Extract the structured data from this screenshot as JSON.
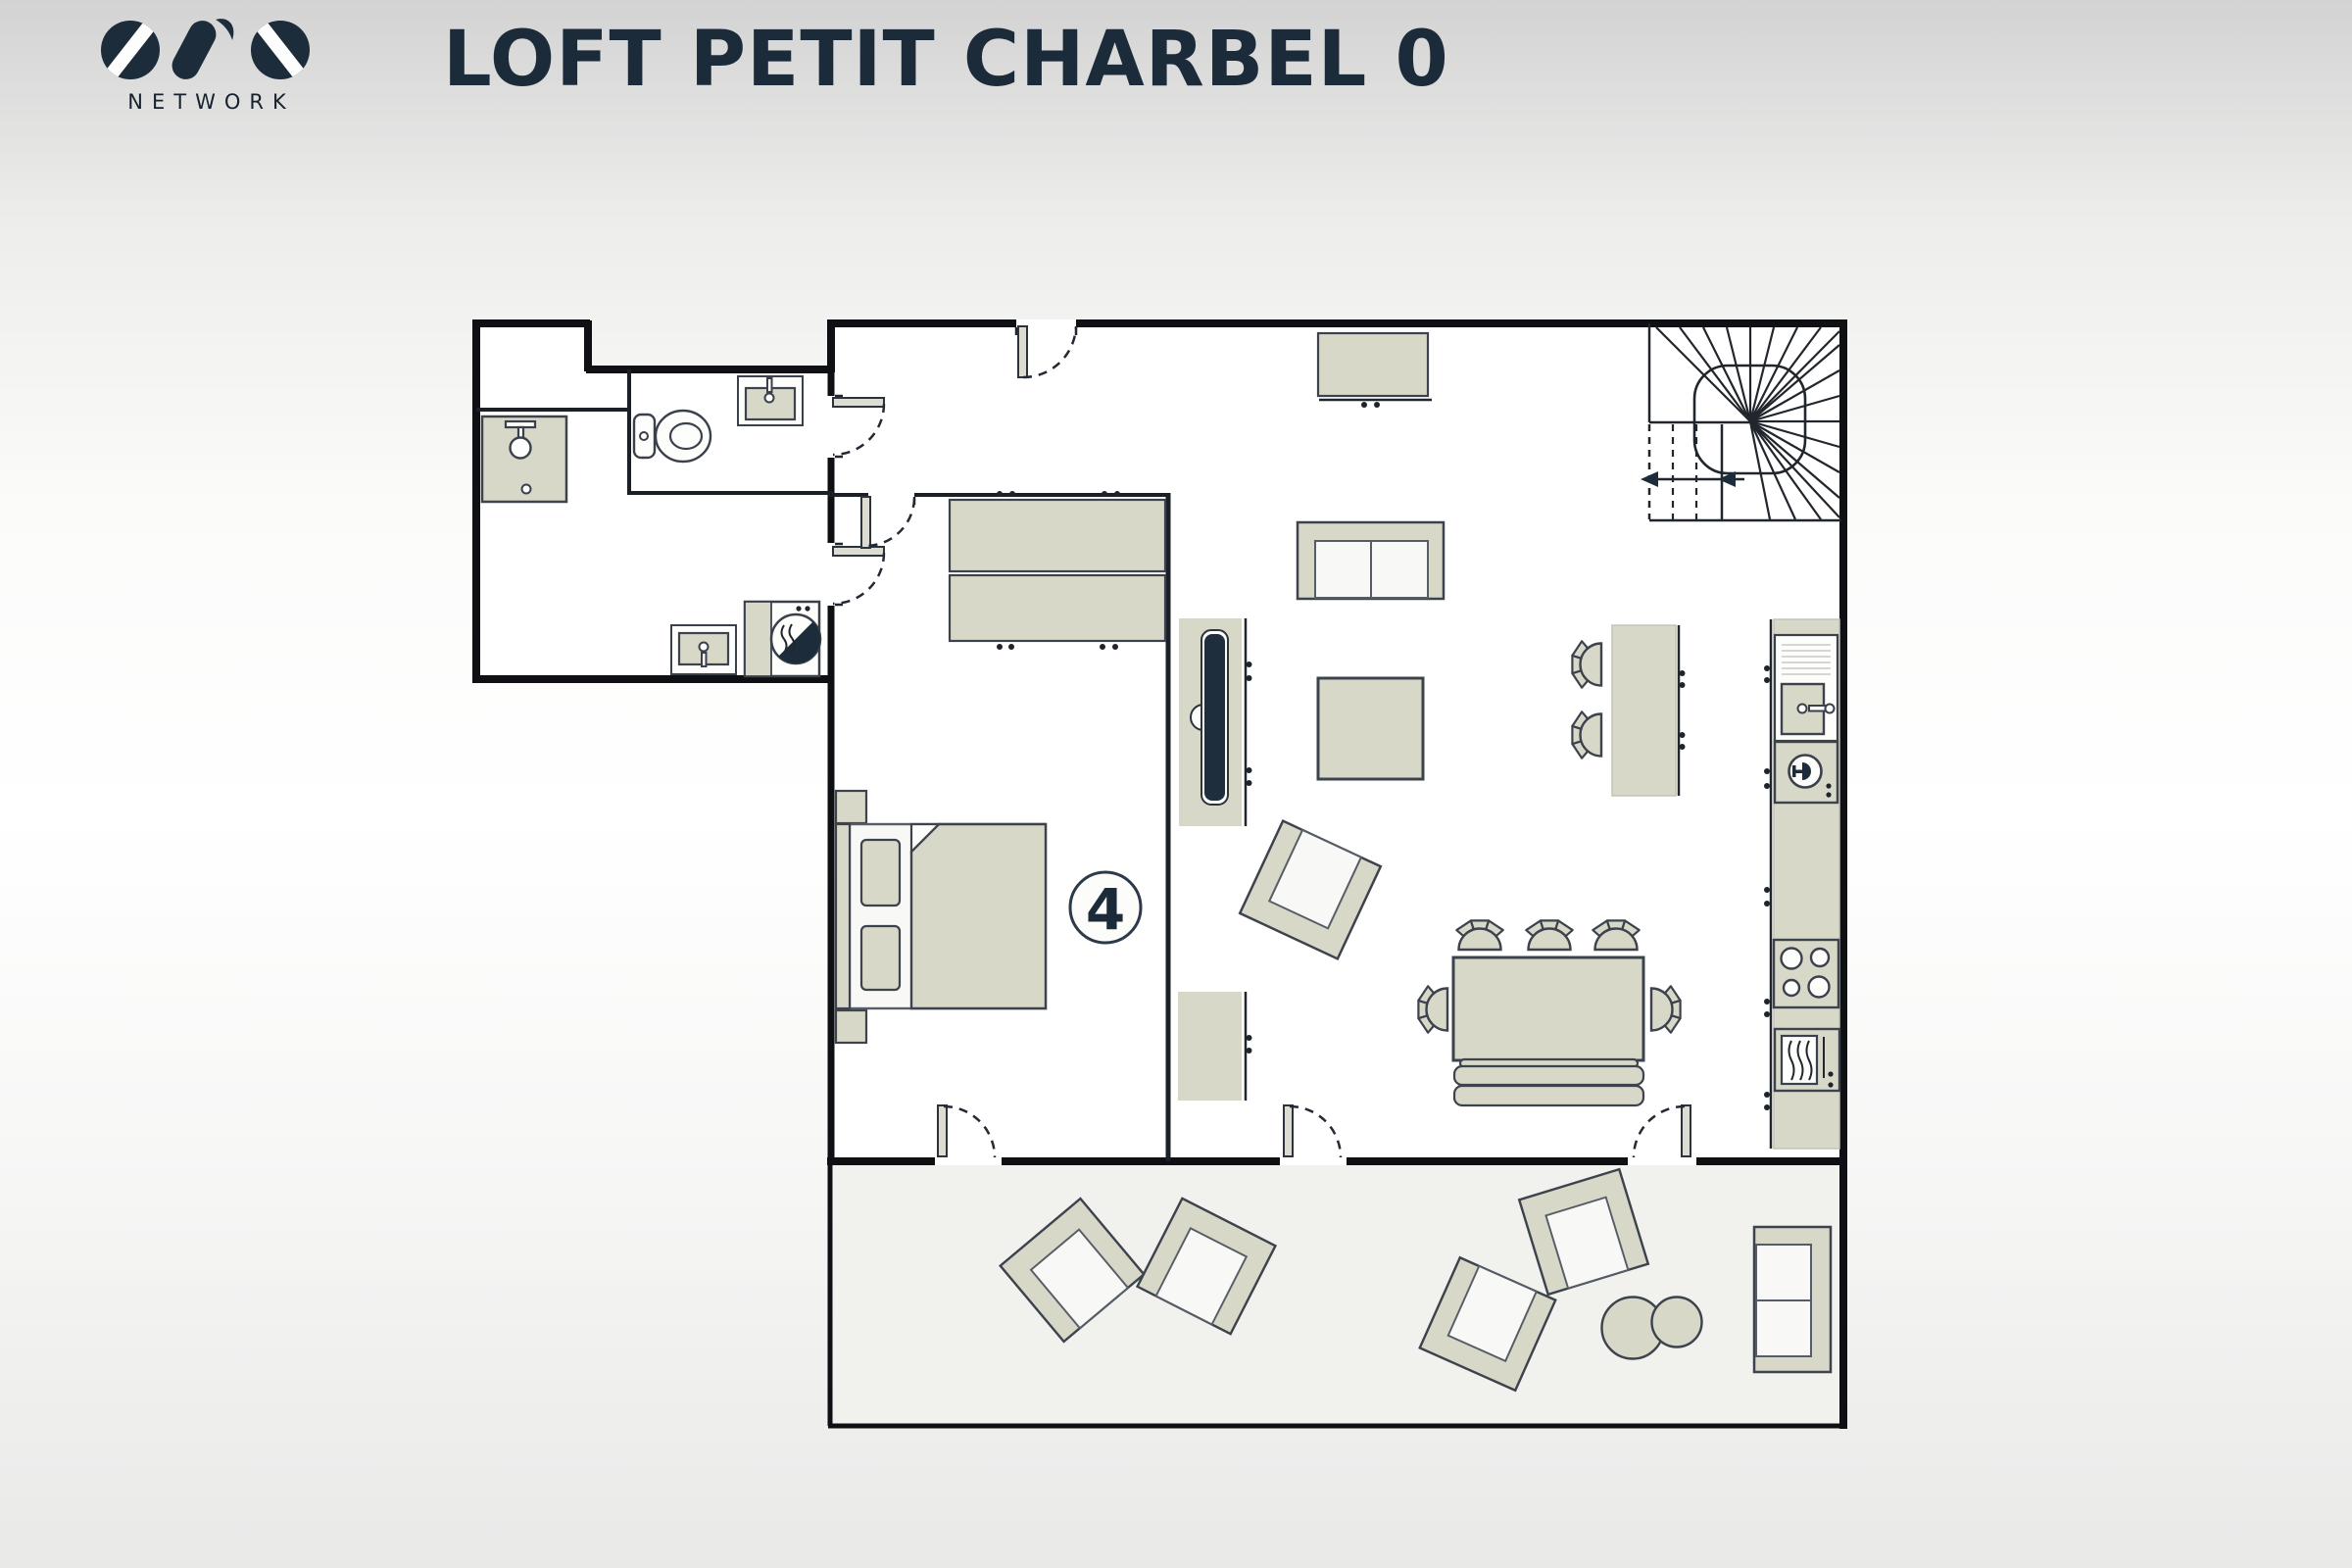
{
  "header": {
    "logo_text": "OVO",
    "logo_subtext": "NETWORK",
    "title": "LOFT PETIT CHARBEL 0"
  },
  "plan": {
    "capacity_label": "4",
    "elements": [
      "shower",
      "toilet",
      "wc-washbasin",
      "utility-washbasin",
      "washing-machine",
      "double-bed",
      "nightstands",
      "wardrobe",
      "bedroom-capacity-badge",
      "tv-panel",
      "tv-sideboard",
      "sofa",
      "coffee-table",
      "armchair",
      "wall-cabinet",
      "sideboard",
      "dining-table",
      "dining-chairs",
      "dining-bench",
      "kitchen-island",
      "bar-stools",
      "kitchen-sink",
      "dishwasher",
      "hob",
      "oven",
      "spiral-staircase",
      "terrace",
      "terrace-armchairs",
      "terrace-side-tables",
      "terrace-sofa",
      "entry-door",
      "wc-door",
      "bathroom-door",
      "bedroom-door",
      "terrace-doors"
    ]
  },
  "colors": {
    "bg-top": "#d3d3d3",
    "bg-mid": "#ffffff",
    "bg-bot": "#e9e9e8",
    "wall": "#0e1013",
    "stroke": "#3c434d",
    "beige": "#d8d8c9",
    "navy": "#1d2c3b",
    "floor": "#ffffff",
    "terrace": "#f1f1ee",
    "seat": "#f8f8f6"
  }
}
